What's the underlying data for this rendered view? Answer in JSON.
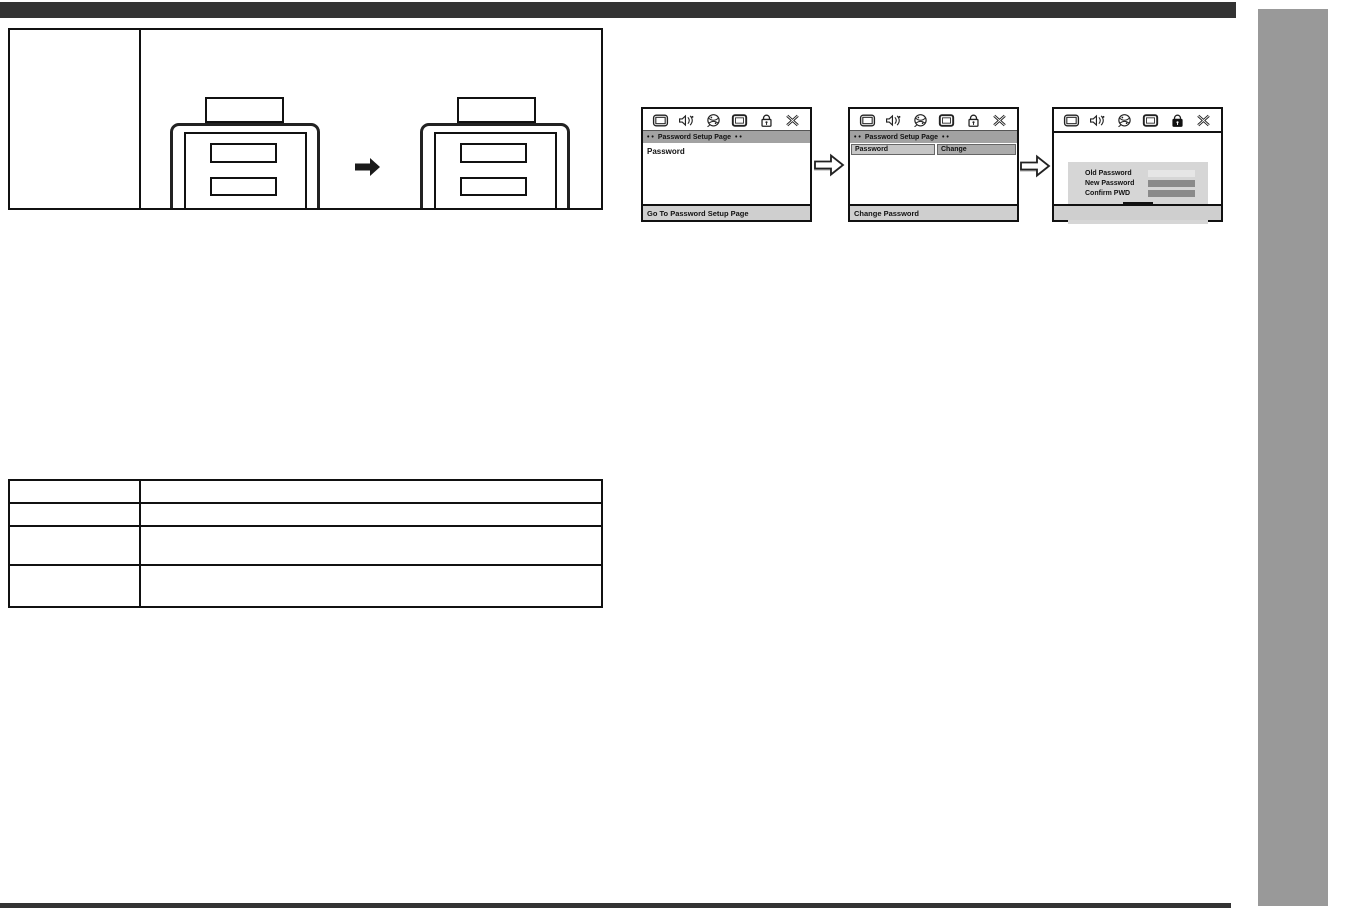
{
  "page": {
    "background": "#ffffff",
    "top_rule_color": "#333333",
    "bottom_rule_color": "#333333",
    "side_tab_color": "#999999"
  },
  "osd": {
    "title_dots": "• •",
    "title": "Password Setup Page",
    "toolbar_icons": [
      "general-setup-icon",
      "audio-setup-icon",
      "preferences-icon",
      "video-setup-icon",
      "password-lock-icon",
      "exit-icon"
    ],
    "colors": {
      "header_bar": "#a2a2a2",
      "status_bar": "#cfcfcf",
      "menu_cell": "#c6c6c6",
      "value_cell": "#ababab",
      "panel": "#d6d6d6",
      "field_active": "#e6e6e6",
      "field_filled": "#8a8a8a"
    },
    "screen1": {
      "menu_label": "Password",
      "footer": "Go To Password Setup Page"
    },
    "screen2": {
      "menu_label": "Password",
      "value_label": "Change",
      "footer": "Change Password"
    },
    "screen3": {
      "field1_label": "Old Password",
      "field2_label": "New Password",
      "field3_label": "Confirm PWD",
      "ok_label": "OK",
      "footer": ""
    }
  }
}
